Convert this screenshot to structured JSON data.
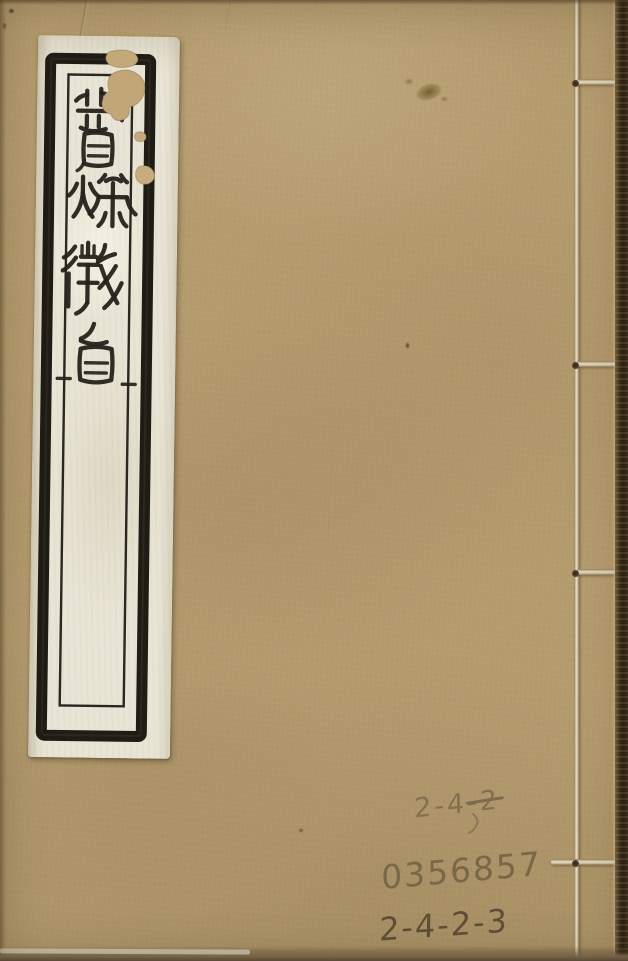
{
  "cover": {
    "title_label": {
      "title": "春秋微旨",
      "characters": [
        "春",
        "秋",
        "微",
        "旨"
      ],
      "paper_color": "#e9e5d6",
      "ink_color": "#26221b"
    },
    "handwriting": {
      "line1_prefix": "2-4-",
      "line1_struck": "2",
      "line2": "0356857",
      "line3": "2-4-2-3",
      "pencil_color": "#6f5d43"
    },
    "binding": {
      "stitches_visible": 4,
      "thread_color": "#e7dcc1"
    },
    "colors": {
      "cover_paper": "#b59c6f",
      "page_block_edge": "#2e2416"
    }
  }
}
